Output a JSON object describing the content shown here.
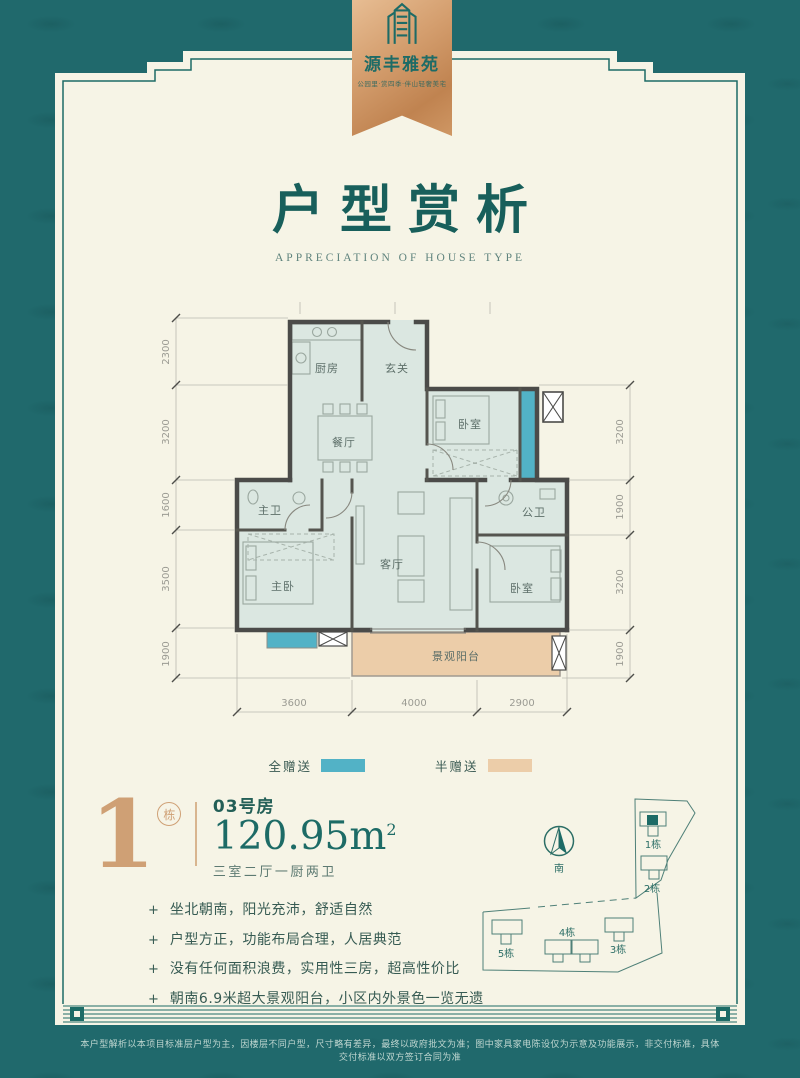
{
  "brand": {
    "name": "源丰雅苑",
    "tagline": "公园里·赏四季·伴山轻奢美宅"
  },
  "title": {
    "zh": "户型赏析",
    "en": "APPRECIATION OF HOUSE TYPE"
  },
  "floorplan": {
    "rooms": {
      "kitchen": "厨房",
      "foyer": "玄关",
      "bedroom_top": "卧室",
      "dining": "餐厅",
      "master_bath": "主卫",
      "public_bath": "公卫",
      "master_bedroom": "主卧",
      "living": "客厅",
      "bedroom_right": "卧室",
      "balcony": "景观阳台"
    },
    "dims": {
      "left": [
        "2300",
        "3200",
        "1600",
        "3500",
        "1900"
      ],
      "right": [
        "3200",
        "1900",
        "3200",
        "1900"
      ],
      "bottom": [
        "3600",
        "4000",
        "2900"
      ]
    },
    "legend": [
      {
        "label": "全赠送",
        "color": "#52b2c6"
      },
      {
        "label": "半赠送",
        "color": "#eccda9"
      }
    ]
  },
  "unit": {
    "building_number": "1",
    "building_badge": "栋",
    "room_no": "03号房",
    "area": "120.95",
    "area_unit": "m",
    "area_sup": "2",
    "layout": "三室二厅一厨两卫"
  },
  "features_marker": "+",
  "features": [
    "坐北朝南，阳光充沛，舒适自然",
    "户型方正，功能布局合理，人居典范",
    "没有任何面积浪费，实用性三房，超高性价比",
    "朝南6.9米超大景观阳台，小区内外景色一览无遗"
  ],
  "compass": {
    "south": "南"
  },
  "siteplan": {
    "buildings": [
      "1栋",
      "2栋",
      "3栋",
      "4栋",
      "5栋"
    ]
  },
  "disclaimer": "本户型解析以本项目标准层户型为主，因楼层不同户型，尺寸略有差异，最终以政府批文为准；图中家具家电陈设仅为示意及功能展示，非交付标准，具体交付标准以双方签订合同为准",
  "colors": {
    "background": "#20696c",
    "card": "#f6f4e6",
    "accent": "#1d6b66",
    "copper": "#cf9b6f",
    "full_gift": "#52b2c6",
    "half_gift": "#eccda9"
  }
}
